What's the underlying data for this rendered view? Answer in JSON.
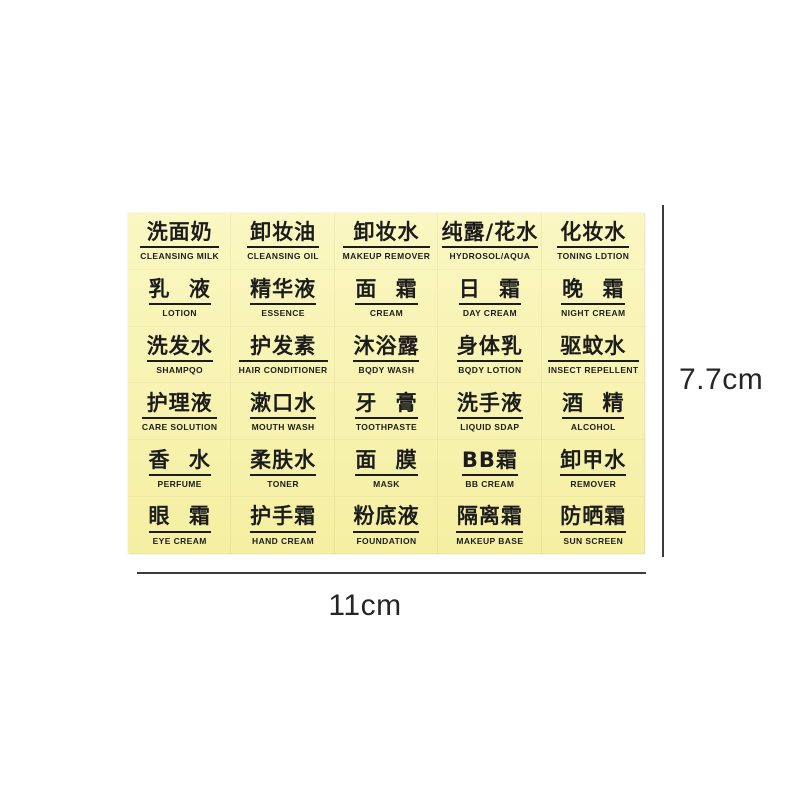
{
  "scene": {
    "background_color": "#ffffff",
    "sheet_color_top": "#faf7c2",
    "sheet_color_bottom": "#f5efa2",
    "label_text_color": "#1c1c1c",
    "dimension_line_color": "#3c3c3c"
  },
  "sheet": {
    "rows": 6,
    "cols": 5,
    "labels": [
      {
        "zh": "洗面奶",
        "en": "CLEANSING MILK"
      },
      {
        "zh": "卸妆油",
        "en": "CLEANSING OIL"
      },
      {
        "zh": "卸妆水",
        "en": "MAKEUP REMOVER"
      },
      {
        "zh": "纯露/花水",
        "en": "HYDROSOL/AQUA"
      },
      {
        "zh": "化妆水",
        "en": "TONING LDTION"
      },
      {
        "zh": "乳 液",
        "en": "LOTION"
      },
      {
        "zh": "精华液",
        "en": "ESSENCE"
      },
      {
        "zh": "面 霜",
        "en": "CREAM"
      },
      {
        "zh": "日 霜",
        "en": "DAY CREAM"
      },
      {
        "zh": "晚 霜",
        "en": "NIGHT CREAM"
      },
      {
        "zh": "洗发水",
        "en": "SHAMPQO"
      },
      {
        "zh": "护发素",
        "en": "HAIR CONDITIONER"
      },
      {
        "zh": "沐浴露",
        "en": "BQDY WASH"
      },
      {
        "zh": "身体乳",
        "en": "BQDY LOTION"
      },
      {
        "zh": "驱蚊水",
        "en": "INSECT REPELLENT"
      },
      {
        "zh": "护理液",
        "en": "CARE SOLUTION"
      },
      {
        "zh": "漱口水",
        "en": "MOUTH WASH"
      },
      {
        "zh": "牙 膏",
        "en": "TOOTHPASTE"
      },
      {
        "zh": "洗手液",
        "en": "LIQUID SDAP"
      },
      {
        "zh": "酒 精",
        "en": "ALCOHOL"
      },
      {
        "zh": "香 水",
        "en": "PERFUME"
      },
      {
        "zh": "柔肤水",
        "en": "TONER"
      },
      {
        "zh": "面 膜",
        "en": "MASK"
      },
      {
        "zh": "BB霜",
        "en": "BB CREAM"
      },
      {
        "zh": "卸甲水",
        "en": "REMOVER"
      },
      {
        "zh": "眼 霜",
        "en": "EYE CREAM"
      },
      {
        "zh": "护手霜",
        "en": "HAND CREAM"
      },
      {
        "zh": "粉底液",
        "en": "FOUNDATION"
      },
      {
        "zh": "隔离霜",
        "en": "MAKEUP BASE"
      },
      {
        "zh": "防晒霜",
        "en": "SUN SCREEN"
      }
    ]
  },
  "dimensions": {
    "height_label": "7.7cm",
    "width_label": "11cm"
  }
}
